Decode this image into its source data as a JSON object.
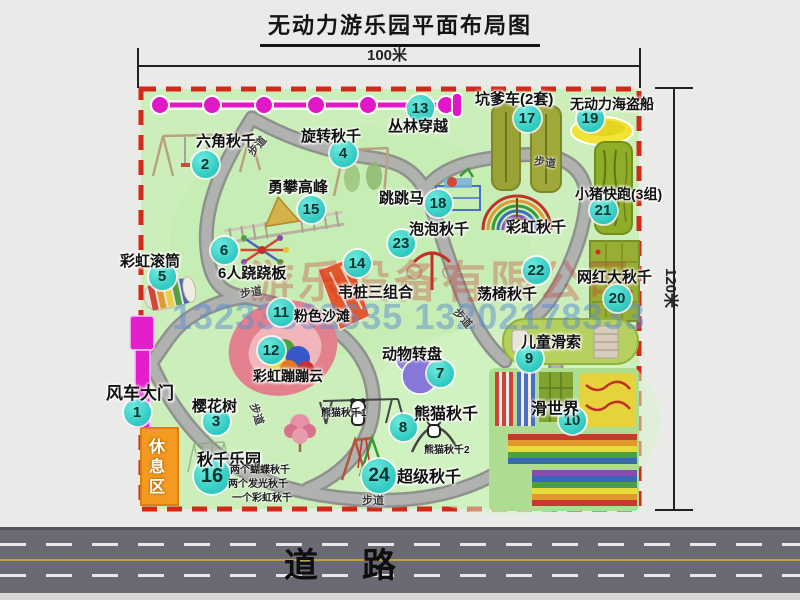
{
  "title": "无动力游乐园平面布局图",
  "dimensions": {
    "horizontal": "100米",
    "vertical": "120米"
  },
  "road": {
    "label": "道路"
  },
  "watermark": {
    "company": "游乐设备有限公司",
    "phone": "13233862635 13202178333"
  },
  "rest_area": {
    "label": "休息区"
  },
  "attractions": [
    {
      "n": "1",
      "t": "风车大门",
      "bx": 137,
      "by": 412,
      "lx": 106,
      "ly": 379,
      "ls": 17
    },
    {
      "n": "2",
      "t": "六角秋千",
      "bx": 205,
      "by": 164,
      "lx": 196,
      "ly": 130
    },
    {
      "n": "3",
      "t": "樱花树",
      "bx": 216,
      "by": 421,
      "lx": 192,
      "ly": 395
    },
    {
      "n": "4",
      "t": "旋转秋千",
      "bx": 343,
      "by": 153,
      "lx": 301,
      "ly": 125
    },
    {
      "n": "5",
      "t": "彩虹滚筒",
      "bx": 162,
      "by": 276,
      "lx": 120,
      "ly": 250
    },
    {
      "n": "6",
      "t": "6人跷跷板",
      "bx": 224,
      "by": 250,
      "lx": 218,
      "ly": 262
    },
    {
      "n": "7",
      "t": "动物转盘",
      "bx": 440,
      "by": 373,
      "lx": 382,
      "ly": 343
    },
    {
      "n": "8",
      "t": "熊猫秋千",
      "bx": 403,
      "by": 427,
      "lx": 414,
      "ly": 400,
      "ls": 16
    },
    {
      "n": "9",
      "t": "儿童滑索",
      "bx": 529,
      "by": 358,
      "lx": 521,
      "ly": 331
    },
    {
      "n": "10",
      "t": "滑世界",
      "bx": 572,
      "by": 420,
      "lx": 531,
      "ly": 395,
      "ls": 16
    },
    {
      "n": "11",
      "t": "粉色沙滩",
      "bx": 281,
      "by": 312,
      "lx": 294,
      "ly": 306,
      "ls": 14
    },
    {
      "n": "12",
      "t": "彩虹蹦蹦云",
      "bx": 271,
      "by": 350,
      "lx": 253,
      "ly": 366,
      "ls": 14
    },
    {
      "n": "13",
      "t": "丛林穿越",
      "bx": 420,
      "by": 108,
      "lx": 388,
      "ly": 115
    },
    {
      "n": "14",
      "t": "韦桩三组合",
      "bx": 357,
      "by": 263,
      "lx": 338,
      "ly": 281
    },
    {
      "n": "15",
      "t": "勇攀高峰",
      "bx": 311,
      "by": 209,
      "lx": 268,
      "ly": 176
    },
    {
      "n": "16",
      "t": "秋千乐园",
      "bx": 212,
      "by": 476,
      "bs": 36,
      "lx": 197,
      "ly": 446,
      "ls": 16
    },
    {
      "n": "17",
      "t": "坑爹车(2套)",
      "bx": 527,
      "by": 118,
      "lx": 475,
      "ly": 88
    },
    {
      "n": "18",
      "t": "跳跳马",
      "bx": 438,
      "by": 203,
      "lx": 379,
      "ly": 187
    },
    {
      "n": "19",
      "t": "无动力海盗船",
      "bx": 590,
      "by": 118,
      "lx": 570,
      "ly": 94,
      "ls": 14
    },
    {
      "n": "20",
      "t": "网红大秋千",
      "bx": 617,
      "by": 298,
      "lx": 577,
      "ly": 266
    },
    {
      "n": "21",
      "t": "小猪快跑(3组)",
      "bx": 603,
      "by": 210,
      "lx": 575,
      "ly": 184,
      "ls": 14
    },
    {
      "n": "22",
      "t": "荡椅秋千",
      "bx": 536,
      "by": 270,
      "lx": 477,
      "ly": 283
    },
    {
      "n": "23",
      "t": "泡泡秋千",
      "bx": 401,
      "by": 243,
      "lx": 409,
      "ly": 218
    },
    {
      "n": "24",
      "t": "超级秋千",
      "bx": 379,
      "by": 476,
      "bs": 34,
      "lx": 397,
      "ly": 463,
      "ls": 16
    },
    {
      "t": "彩虹秋千",
      "lx": 506,
      "ly": 216
    }
  ],
  "sub_labels": [
    {
      "t": "熊猫秋千1",
      "x": 321,
      "y": 404
    },
    {
      "t": "熊猫秋千2",
      "x": 424,
      "y": 441
    },
    {
      "t": "两个蝴蝶秋千",
      "x": 230,
      "y": 461
    },
    {
      "t": "两个发光秋千",
      "x": 228,
      "y": 475
    },
    {
      "t": "一个彩虹秋千",
      "x": 232,
      "y": 489
    }
  ],
  "path_labels": [
    {
      "t": "步道",
      "x": 246,
      "y": 138,
      "r": -50
    },
    {
      "t": "步道",
      "x": 240,
      "y": 284,
      "r": -8
    },
    {
      "t": "步道",
      "x": 534,
      "y": 154,
      "r": 8
    },
    {
      "t": "步道",
      "x": 452,
      "y": 310,
      "r": 48
    },
    {
      "t": "步道",
      "x": 246,
      "y": 406,
      "r": 72
    },
    {
      "t": "步道",
      "x": 362,
      "y": 492,
      "r": 0
    }
  ]
}
